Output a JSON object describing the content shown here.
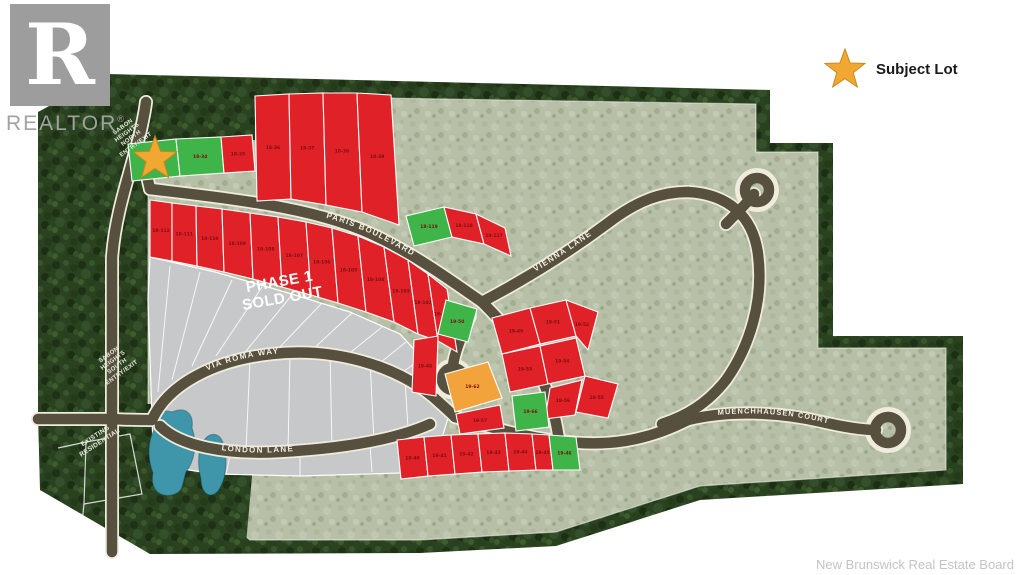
{
  "logo": {
    "monogram": "R",
    "brand": "REALTOR",
    "registered": "®"
  },
  "legend": {
    "label": "Subject Lot"
  },
  "attribution": {
    "text": "New Brunswick Real Estate Board"
  },
  "area_labels": {
    "phase1": "PHASE 1\nSOLD OUT",
    "north_entry": "SABON\nHEIGHTS\nNORTH\nENTRY/EXIT",
    "south_entry": "SABON\nHEIGHTS\nSOUTH\nENTRY/EXIT",
    "existing_residential": "EXISTING\nRESIDENTIAL"
  },
  "streets": [
    {
      "name": "PARIS BOULEVARD"
    },
    {
      "name": "VIENNA LANE"
    },
    {
      "name": "VIA ROMA WAY"
    },
    {
      "name": "LONDON LANE"
    },
    {
      "name": "MUENCHHAUSEN COURT"
    }
  ],
  "colors": {
    "available_red": "#E02127",
    "feature_green": "#3EB449",
    "feature_orange": "#F2A33C",
    "sold_gray": "#C7C8CA",
    "road": "#57503F",
    "road_edge": "#EFECDD",
    "trees": "#2A421F",
    "field": "#B7C0A7",
    "pond": "#3F96AB",
    "star": "#F0A832"
  },
  "lots": [
    {
      "id": "subject",
      "points": "128,144 176,139 180,176 132,181",
      "fill": "green",
      "label": ""
    },
    {
      "points": "176,139 221,137 224,173 180,176",
      "fill": "green",
      "label": "18-34"
    },
    {
      "points": "221,137 252,135 255,171 224,173",
      "fill": "red",
      "label": "18-35"
    },
    {
      "points": "255,96 289,94 291,199 257,201",
      "fill": "red",
      "label": "18-36"
    },
    {
      "points": "289,94 323,93 326,205 291,199",
      "fill": "red",
      "label": "18-37"
    },
    {
      "points": "323,93 357,93 362,212 326,205",
      "fill": "red",
      "label": "18-38"
    },
    {
      "points": "357,93 391,95 399,225 362,212",
      "fill": "red",
      "label": "18-39"
    },
    {
      "points": "406,216 444,207 452,237 414,246",
      "fill": "green",
      "label": "18-119"
    },
    {
      "points": "444,207 476,214 484,244 452,237",
      "fill": "red",
      "label": "18-118"
    },
    {
      "points": "476,214 505,228 511,256 484,244",
      "fill": "red",
      "label": "18-117"
    },
    {
      "points": "150,200 172,203 172,261 150,257",
      "fill": "red",
      "label": "18-112"
    },
    {
      "points": "172,203 196,206 197,266 172,261",
      "fill": "red",
      "label": "18-111"
    },
    {
      "points": "196,206 222,209 224,272 197,266",
      "fill": "red",
      "label": "18-110"
    },
    {
      "points": "222,209 250,213 253,279 224,272",
      "fill": "red",
      "label": "18-109"
    },
    {
      "points": "250,213 278,217 282,287 253,279",
      "fill": "red",
      "label": "18-108"
    },
    {
      "points": "278,217 306,222 311,295 282,287",
      "fill": "red",
      "label": "18-107"
    },
    {
      "points": "306,222 332,228 338,303 311,295",
      "fill": "red",
      "label": "18-106"
    },
    {
      "points": "332,228 358,236 366,312 338,303",
      "fill": "red",
      "label": "18-105"
    },
    {
      "points": "358,236 384,247 394,322 366,312",
      "fill": "red",
      "label": "18-104"
    },
    {
      "points": "384,247 408,260 418,334 394,322",
      "fill": "red",
      "label": "18-103"
    },
    {
      "points": "408,260 428,274 438,341 418,334",
      "fill": "red",
      "label": "18-102"
    },
    {
      "points": "428,274 447,289 457,352 438,341",
      "fill": "red",
      "label": "18-101"
    },
    {
      "points": "446,300 477,309 468,342 438,334",
      "fill": "green",
      "label": "19-50"
    },
    {
      "points": "414,340 438,336 436,396 412,392",
      "fill": "red",
      "label": "19-48"
    },
    {
      "points": "492,318 530,308 540,344 502,354",
      "fill": "red",
      "label": "19-49"
    },
    {
      "points": "530,308 566,300 576,336 540,344",
      "fill": "red",
      "label": "19-51"
    },
    {
      "points": "566,300 598,312 588,350 576,336",
      "fill": "red",
      "label": "19-52"
    },
    {
      "points": "502,354 540,346 548,384 510,392",
      "fill": "red",
      "label": "19-53"
    },
    {
      "points": "540,346 576,338 585,376 548,384",
      "fill": "red",
      "label": "19-54"
    },
    {
      "points": "585,376 618,384 608,418 576,412",
      "fill": "red",
      "label": "19-55"
    },
    {
      "points": "550,388 582,380 575,415 545,419",
      "fill": "red",
      "label": "19-56"
    },
    {
      "id": "orange-feature",
      "points": "445,374 488,362 502,398 455,412",
      "fill": "orange",
      "label": "19-62"
    },
    {
      "points": "512,396 545,392 549,427 516,431",
      "fill": "green",
      "label": "19-66"
    },
    {
      "points": "456,414 500,405 504,428 460,434",
      "fill": "red",
      "label": "19-57"
    },
    {
      "points": "397,440 424,437 428,476 401,479",
      "fill": "red",
      "label": "19-40"
    },
    {
      "points": "424,437 451,435 455,474 428,476",
      "fill": "red",
      "label": "19-41"
    },
    {
      "points": "451,435 478,434 482,472 455,474",
      "fill": "red",
      "label": "19-42"
    },
    {
      "points": "478,434 505,433 509,471 482,472",
      "fill": "red",
      "label": "19-43"
    },
    {
      "points": "505,433 532,434 536,470 509,471",
      "fill": "red",
      "label": "19-44"
    },
    {
      "points": "532,434 549,435 553,470 536,470",
      "fill": "red",
      "label": "19-45"
    },
    {
      "points": "549,435 576,437 580,470 553,470",
      "fill": "green",
      "label": "19-46"
    }
  ]
}
